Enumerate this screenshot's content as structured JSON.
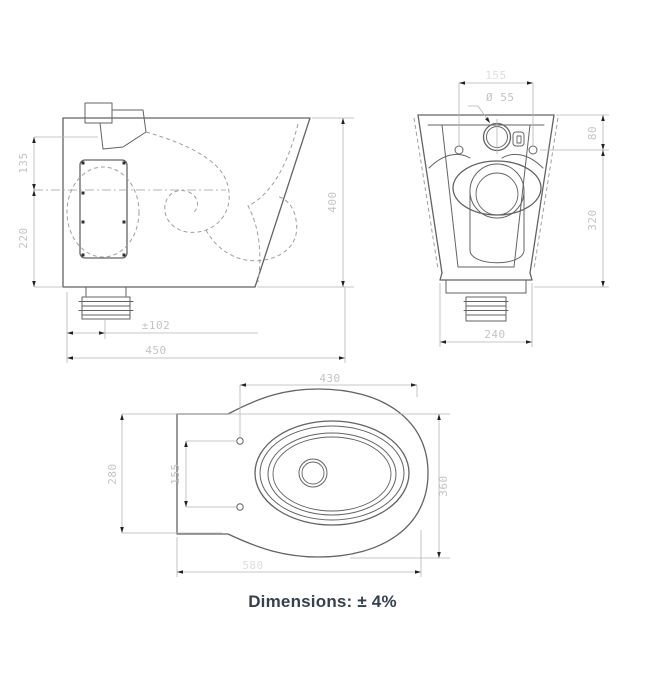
{
  "drawing": {
    "footer_note": "Dimensions: ± 4%",
    "views": {
      "side": {
        "dims": {
          "inlet_height": "135",
          "fixing_plate_height": "220",
          "overall_height": "400",
          "outlet_setout": "±102",
          "overall_depth": "450"
        }
      },
      "front": {
        "dims": {
          "fixing_hole_spacing": "155",
          "flush_hole_diameter": "Ø 55",
          "top_to_fixing_holes": "80",
          "fixing_holes_to_base": "320",
          "base_width": "240"
        }
      },
      "plan": {
        "dims": {
          "fixing_holes_to_front": "430",
          "back_section_depth": "280",
          "fixing_hole_spacing": "155",
          "bowl_width": "360",
          "overall_length": "580"
        }
      }
    }
  },
  "colors": {
    "line_dark": "#636363",
    "line_light": "#9f9f9f",
    "dim_line": "#b5b5b5",
    "dim_text": "#c4c4c4",
    "dim_text_faint": "#dedede",
    "arrow": "#222222",
    "footer_text": "#36404e",
    "background": "#ffffff"
  }
}
